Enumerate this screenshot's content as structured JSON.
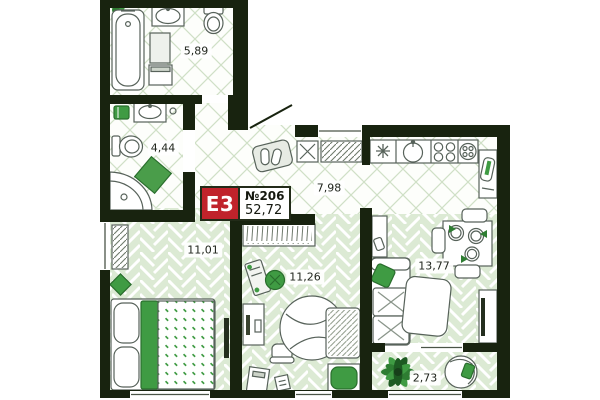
{
  "badge": {
    "unit_type": "E3",
    "number": "№206",
    "area_total": "52,72"
  },
  "rooms": [
    {
      "name": "bathroom-large",
      "area": "5,89"
    },
    {
      "name": "bathroom-small",
      "area": "4,44"
    },
    {
      "name": "kitchen",
      "area": "7,98"
    },
    {
      "name": "bedroom",
      "area": "11,01"
    },
    {
      "name": "room",
      "area": "11,26"
    },
    {
      "name": "living-room",
      "area": "13,77"
    },
    {
      "name": "balcony",
      "area": "2,73"
    }
  ],
  "colors": {
    "wall": "#18230f",
    "badge_red": "#c0232b",
    "accent_green": "#3f9b43",
    "accent_green_dark": "#2a6e2d",
    "floor_green": "#dcead4",
    "lattice_line": "#cfe0c6"
  }
}
